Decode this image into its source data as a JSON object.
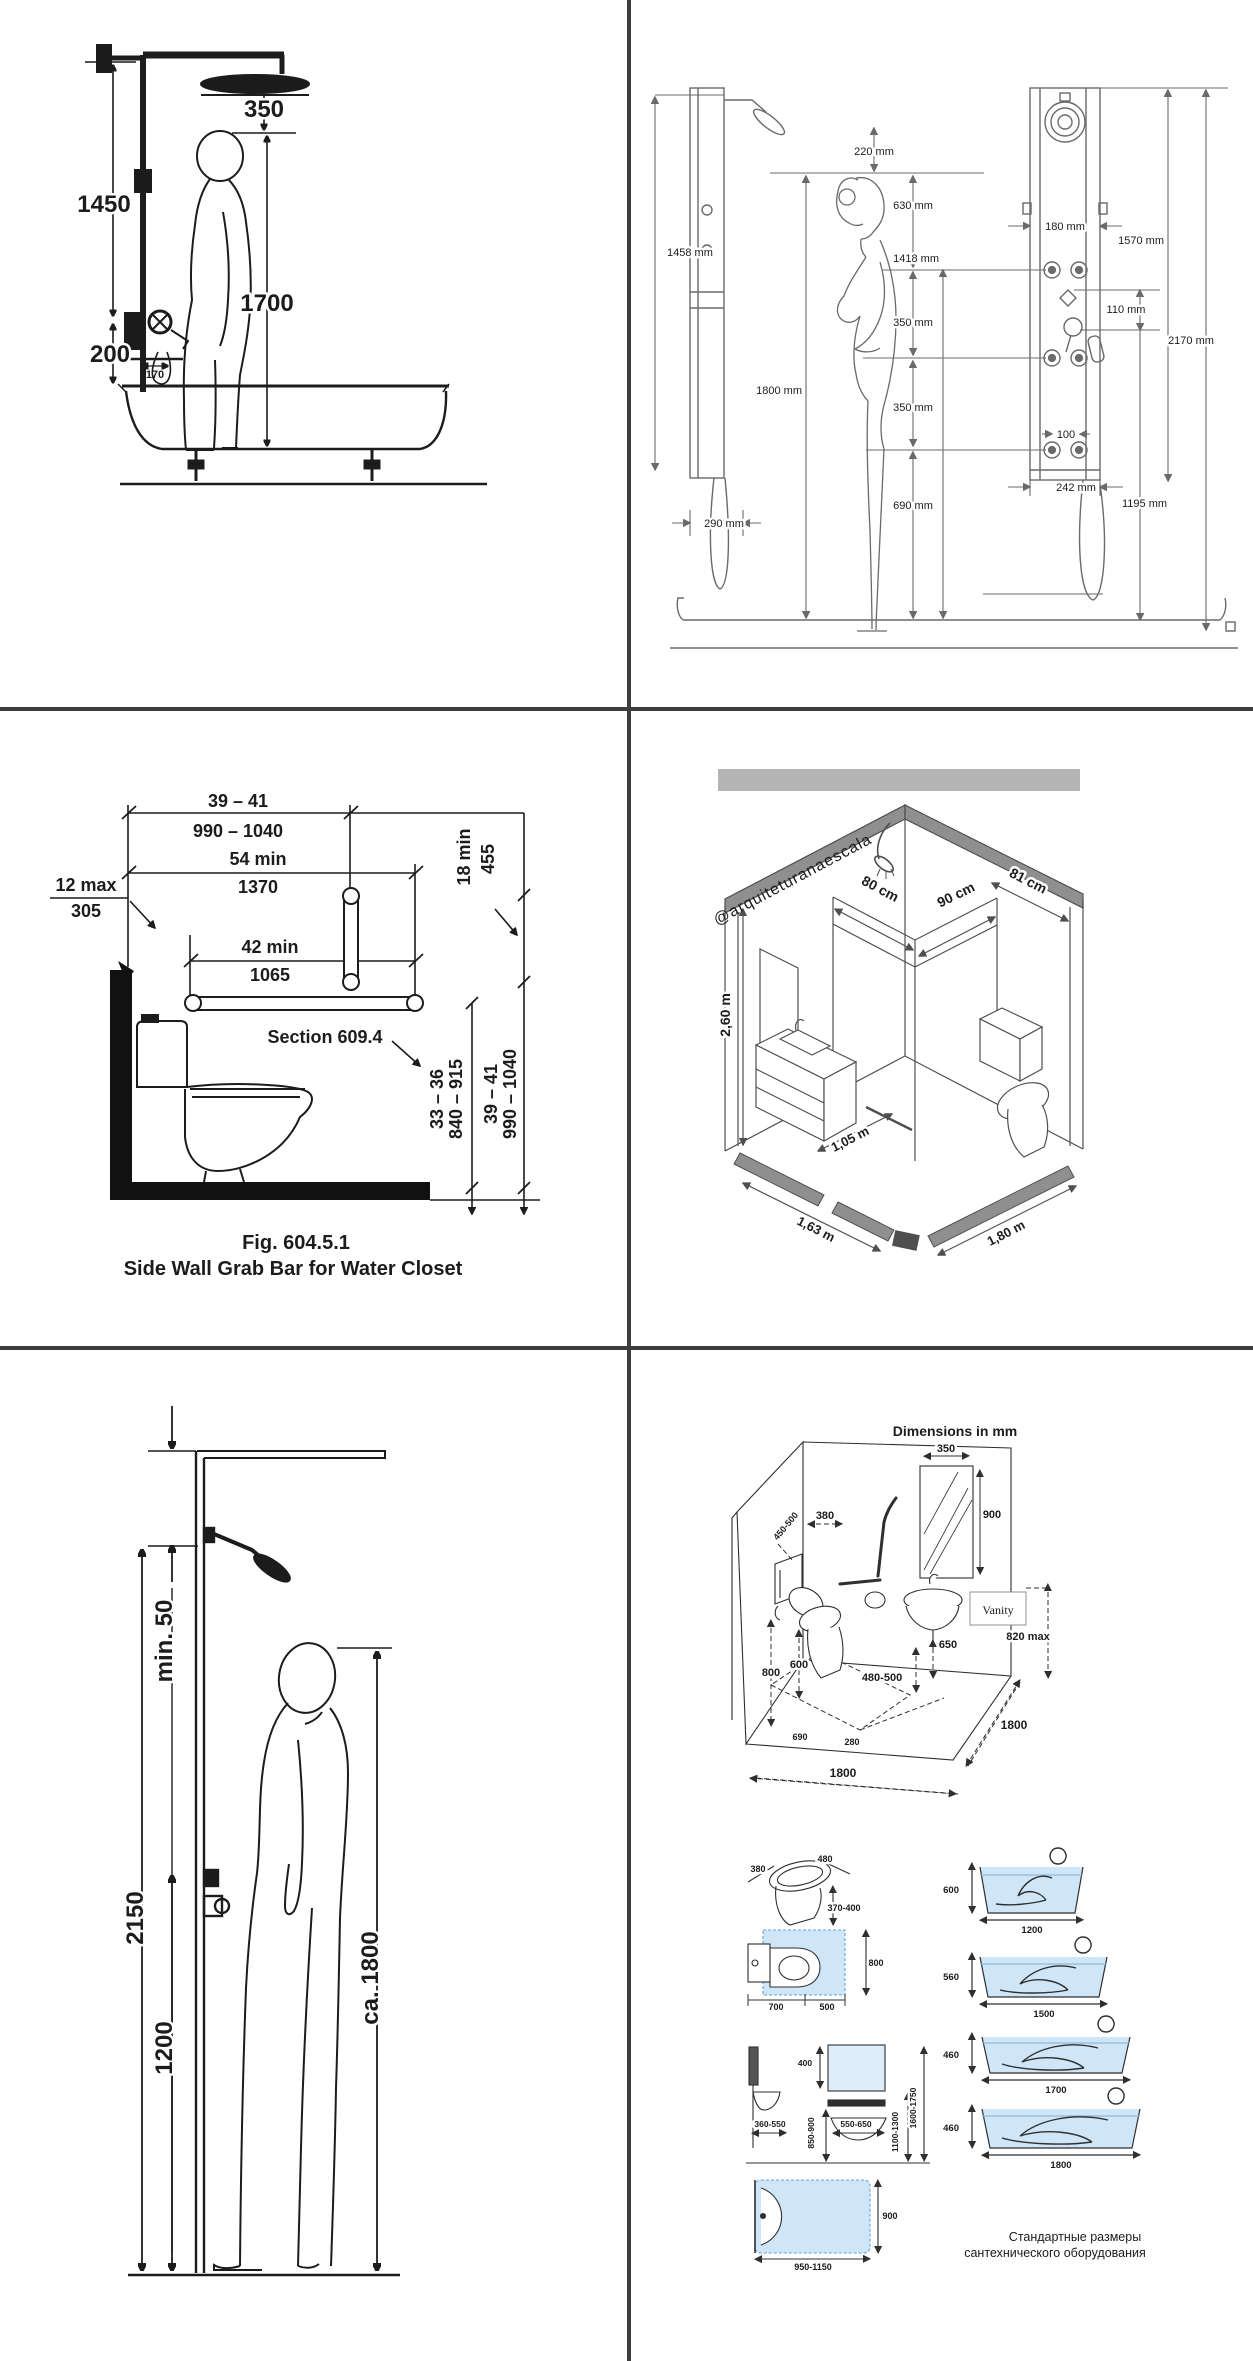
{
  "page": {
    "description": "Collage of six sanitary-fixture dimension diagrams",
    "divider_color": "#3d3d3d"
  },
  "colors": {
    "ink_dark": "#1c1c1c",
    "ink_scan": "#6a6a6a",
    "ink_iso": "#4f4f4f",
    "gray_cap": "#8f8f8f",
    "gray_band": "#b4b4b4",
    "blue_fill": "#cfe6f8",
    "blue_dash": "#66a3d9",
    "blue_text": "#4a80c4"
  },
  "panels": {
    "p1": {
      "d350": "350",
      "d1450": "1450",
      "d1700": "1700",
      "d200": "200",
      "d170": "170"
    },
    "p2": {
      "d1458": "1458 mm",
      "d290": "290 mm",
      "d220": "220 mm",
      "d630": "630 mm",
      "d1418": "1418 mm",
      "d1800": "1800 mm",
      "d350a": "350 mm",
      "d350b": "350 mm",
      "d690": "690 mm",
      "d180": "180 mm",
      "d1570": "1570 mm",
      "d110": "110 mm",
      "d100": "100",
      "d242": "242 mm",
      "d1195": "1195 mm",
      "d2170": "2170 mm"
    },
    "p3": {
      "r1a": "39 – 41",
      "r1b": "990 – 1040",
      "r2a": "54 min",
      "r2b": "1370",
      "r3a": "12 max",
      "r3b": "305",
      "r4a": "42 min",
      "r4b": "1065",
      "r5a": "18 min",
      "r5b": "455",
      "section": "Section 609.4",
      "v1a": "33 – 36",
      "v1b": "840 – 915",
      "v2a": "39 – 41",
      "v2b": "990 – 1040",
      "fig": "Fig. 604.5.1",
      "caption": "Side Wall Grab Bar for Water Closet"
    },
    "p4": {
      "watermark": "@arquiteturanaescala",
      "d80": "80 cm",
      "d90": "90 cm",
      "d81": "81 cm",
      "h260": "2,60 m",
      "d105": "1,05 m",
      "d163": "1,63 m",
      "d180": "1,80 m"
    },
    "p5": {
      "min50": "min. 50",
      "d2150": "2150",
      "d1200": "1200",
      "d1800": "ca. 1800"
    },
    "p6": {
      "title": "Dimensions in mm",
      "room": {
        "d350": "350",
        "d900": "900",
        "d380": "380",
        "d450": "450-500",
        "d800": "800",
        "d600": "600",
        "d480": "480-500",
        "d650": "650",
        "vanity": "Vanity",
        "d820": "820 max",
        "d690": "690",
        "d280": "280",
        "d1800f": "1800",
        "d1800r": "1800"
      },
      "wc": {
        "d380": "380",
        "d480": "480",
        "d370": "370-400",
        "d800": "800",
        "d700": "700",
        "d500": "500"
      },
      "basin": {
        "d400": "400",
        "d360": "360-550",
        "d850": "850-900",
        "d550": "550-650",
        "d1100": "1100-1300",
        "d1600": "1600-1750"
      },
      "shower": {
        "d900": "900",
        "d950": "950-1150"
      },
      "tubs": [
        {
          "h": "600",
          "l": "1200"
        },
        {
          "h": "560",
          "l": "1500"
        },
        {
          "h": "460",
          "l": "1700"
        },
        {
          "h": "460",
          "l": "1800"
        }
      ],
      "caption1": "Стандартные размеры",
      "caption2": "сантехнического оборудования"
    }
  }
}
